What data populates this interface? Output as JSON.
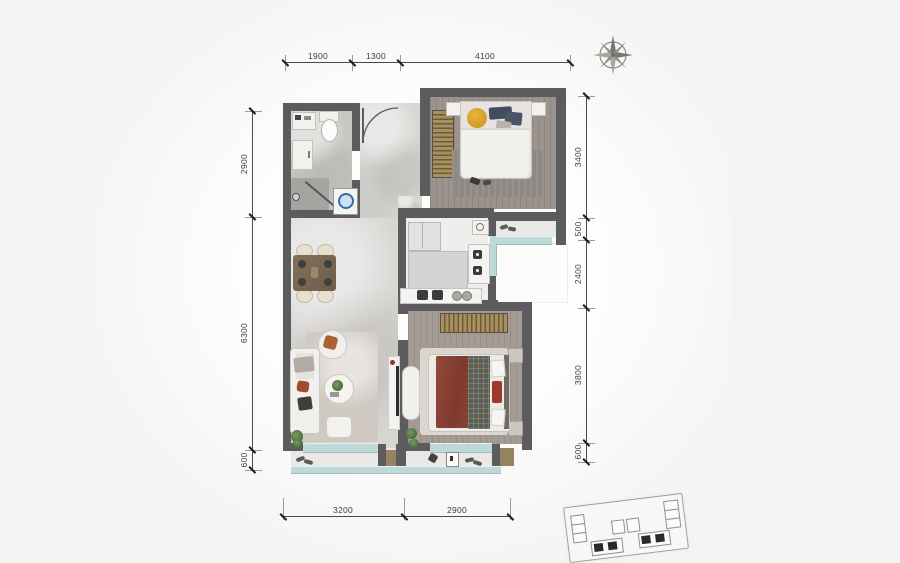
{
  "plan": {
    "kind": "apartment-floor-plan",
    "dimensions": {
      "top": [
        "1900",
        "1300",
        "4100"
      ],
      "right": [
        "3400",
        "500",
        "2400",
        "3800",
        "600"
      ],
      "left": [
        "2900",
        "6300",
        "600"
      ],
      "bottom": [
        "3200",
        "2900"
      ]
    },
    "colors": {
      "wall": "#5c5b5e",
      "glass_window": "#bedad8",
      "wood_floor": "#9c938d",
      "marble_tile": "#d8d6d3",
      "wardrobe_stripe": "#a8905e",
      "bed1_pillow_yellow": "#e3aa2e",
      "bed1_pillow_navy": "#424e60",
      "bed2_blanket_red": "#8c4335",
      "washer_ring_blue": "#2f6fae"
    },
    "icons": [
      "compass-rose-icon",
      "key-plan-inset",
      "entry-door-arc",
      "toilet-icon",
      "washer-icon",
      "stove-icon",
      "sink-icon",
      "shoes-icon"
    ]
  }
}
